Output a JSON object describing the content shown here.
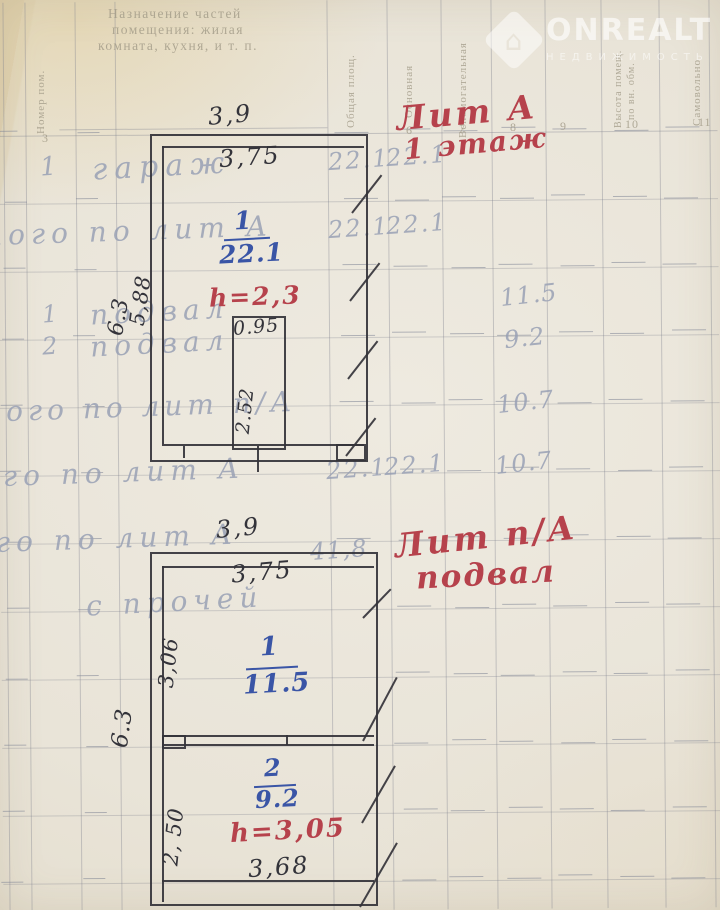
{
  "watermark": {
    "brand": "ONREALT",
    "tagline": "НЕДВИЖИМОСТЬ"
  },
  "form": {
    "caption_line1": "Назначение частей",
    "caption_line2": "помещения: жилая",
    "caption_line3": "комната, кухня, и т. п.",
    "vh_nomer": "Номер пом.",
    "vh_obsh": "Общая площ.",
    "vh_osn": "Основная",
    "vh_vspom": "Вспомогательная",
    "vh_vysota1": "Высота помещ.",
    "vh_vysota2": "по вн. обм.",
    "vh_samovol": "Самовольно",
    "col_num_left": "3",
    "col_nums": [
      "6",
      "7",
      "8",
      "9",
      "10",
      "11"
    ]
  },
  "rows": [
    {
      "num": "1",
      "name": "гараж",
      "c1": "22.1",
      "c2": "22.1"
    },
    {
      "name": "Итого по лит А",
      "c1": "22.1",
      "c2": "22.1"
    },
    {
      "num": "1",
      "name": "подвал",
      "c3": "11.5"
    },
    {
      "num": "2",
      "name": "подвал",
      "c3": "9.2"
    },
    {
      "name": "Итого по лит п/А",
      "c3": "10.7"
    },
    {
      "name": "Всего по лит А",
      "c1": "22.1",
      "c2": "22.1",
      "c3": "10.7"
    },
    {
      "name": "Всего по лит А",
      "c1": "41,8"
    },
    {
      "name": "с прочей"
    }
  ],
  "plan_upper": {
    "title": "Лит А",
    "subtitle": "1 этаж",
    "width_out": "3,9",
    "width_in": "3,75",
    "room_no": "1",
    "room_area": "22.1",
    "height": "h=2,3",
    "pit_w": "0.95",
    "pit_h": "2.52",
    "side_in": "5,88",
    "side_out": "6.3"
  },
  "plan_lower": {
    "title": "Лит п/А",
    "subtitle": "подвал",
    "width_out": "3,9",
    "width_in": "3,75",
    "r1_no": "1",
    "r1_area": "11.5",
    "r1_side": "3,06",
    "r2_no": "2",
    "r2_area": "9.2",
    "r2_side": "2, 50",
    "height": "h=3,05",
    "width_bottom": "3,68",
    "side_out": "6.3"
  }
}
